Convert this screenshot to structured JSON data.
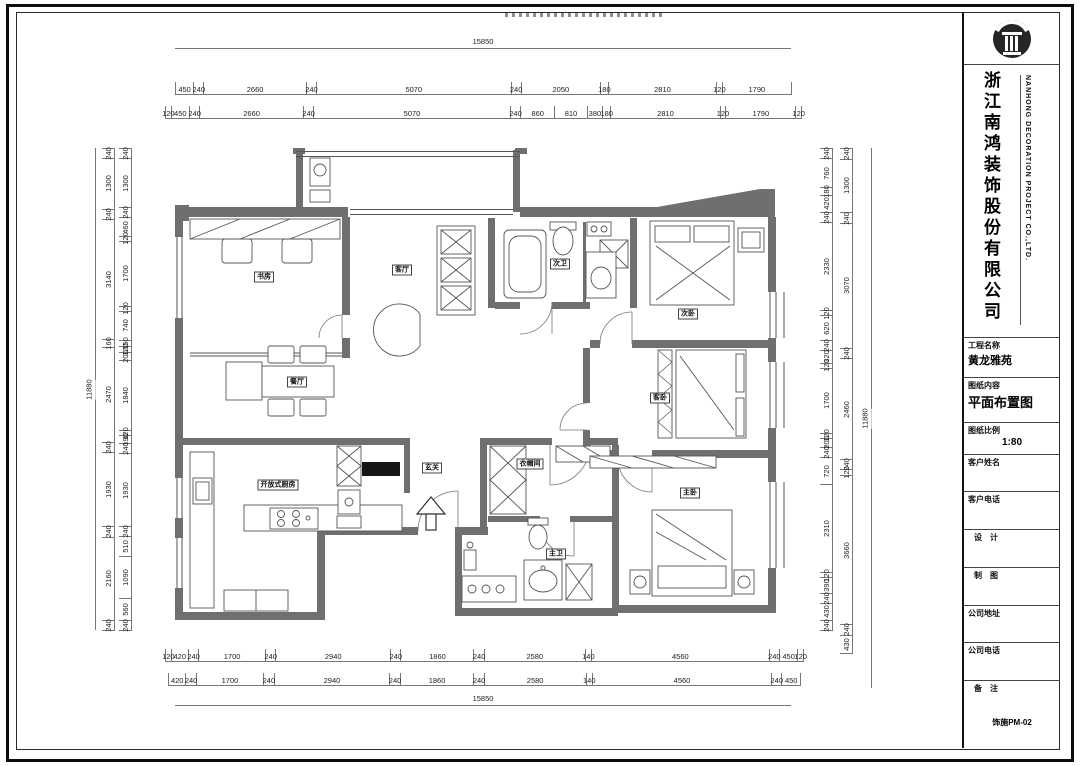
{
  "colors": {
    "wall": "#6f6f6f",
    "line": "#555555",
    "paper": "#ffffff",
    "frame": "#0d0d0d"
  },
  "title_block": {
    "logo_name": "nanhong-column-logo",
    "company_cn": "浙江南鸿装饰股份有限公司",
    "company_en": "NANHONG DECORATION PROJECT CO.,LTD.",
    "fields": {
      "project_label": "工程名称",
      "project_value": "黄龙雅苑",
      "content_label": "图纸内容",
      "content_value": "平面布置图",
      "scale_label": "图纸比例",
      "scale_value": "1:80",
      "client_name_label": "客户姓名",
      "client_name_value": "",
      "client_phone_label": "客户电话",
      "client_phone_value": "",
      "designer_label": "设　计",
      "designer_value": "",
      "drafter_label": "制　图",
      "drafter_value": "",
      "company_addr_label": "公司地址",
      "company_addr_value": "",
      "company_phone_label": "公司电话",
      "company_phone_value": "",
      "remark_label": "备　注",
      "remark_value": "",
      "drawing_no": "饰施PM-02"
    }
  },
  "plan": {
    "rooms": [
      {
        "label": "书房",
        "x": 264,
        "y": 277
      },
      {
        "label": "餐厅",
        "x": 297,
        "y": 382
      },
      {
        "label": "客厅",
        "x": 402,
        "y": 270
      },
      {
        "label": "次卫",
        "x": 560,
        "y": 264
      },
      {
        "label": "次卧",
        "x": 688,
        "y": 314
      },
      {
        "label": "客卧",
        "x": 660,
        "y": 398
      },
      {
        "label": "开放式厨房",
        "x": 278,
        "y": 485
      },
      {
        "label": "玄关",
        "x": 432,
        "y": 468
      },
      {
        "label": "衣帽间",
        "x": 530,
        "y": 464
      },
      {
        "label": "主卫",
        "x": 556,
        "y": 554
      },
      {
        "label": "主卧",
        "x": 690,
        "y": 493
      }
    ],
    "dims": {
      "top_total": "15850",
      "top_row1": [
        450,
        240,
        2660,
        240,
        5070,
        240,
        2050,
        180,
        2810,
        120,
        1790
      ],
      "top_row2": [
        120,
        450,
        240,
        2660,
        240,
        5070,
        240,
        860,
        810,
        380,
        180,
        2810,
        120,
        1790,
        120
      ],
      "bottom_row1": [
        120,
        420,
        240,
        1700,
        240,
        2940,
        240,
        1860,
        240,
        2580,
        140,
        4560,
        240,
        450,
        120
      ],
      "bottom_row2": [
        420,
        240,
        1700,
        240,
        2940,
        240,
        1860,
        240,
        2580,
        140,
        4560,
        240,
        450
      ],
      "bottom_total": "15850",
      "left_total": "11880",
      "left_col_outer": [
        240,
        1300,
        240,
        3140,
        160,
        2470,
        240,
        1930,
        240,
        2160,
        240
      ],
      "left_col_inner": [
        240,
        1300,
        240,
        460,
        120,
        1700,
        120,
        740,
        150,
        120,
        200,
        1840,
        120,
        190,
        240,
        1930,
        240,
        510,
        1090,
        560,
        240
      ],
      "right_total": "11880",
      "right_col_outer": [
        240,
        1300,
        240,
        3070,
        240,
        2460,
        240,
        120,
        3660,
        240,
        430
      ],
      "right_col_inner": [
        240,
        760,
        180,
        420,
        240,
        2330,
        120,
        620,
        240,
        320,
        120,
        1700,
        120,
        200,
        240,
        720,
        2310,
        120,
        390,
        240,
        430,
        240
      ]
    }
  }
}
